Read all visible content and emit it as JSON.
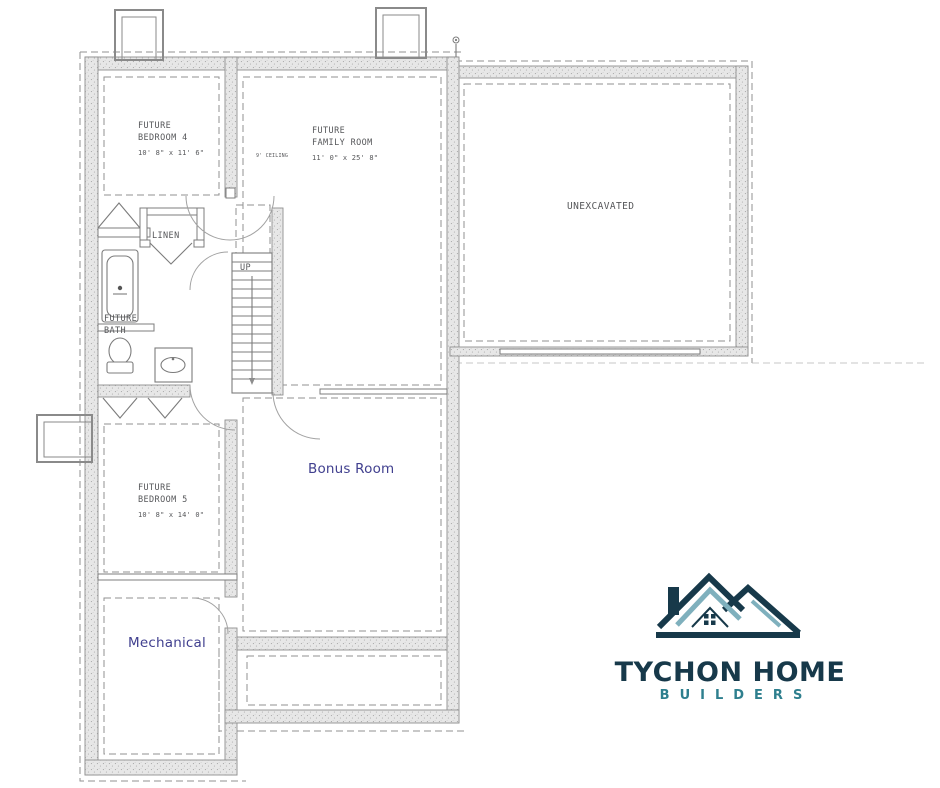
{
  "plan": {
    "title": "Basement / foundation floor plan",
    "rooms": {
      "bedroom4": {
        "line1": "FUTURE",
        "line2": "BEDROOM 4",
        "dims": "10' 8\" x 11' 6\""
      },
      "family_room": {
        "line1": "FUTURE",
        "line2": "FAMILY ROOM",
        "dims": "11' 0\" x 25' 8\""
      },
      "unexcavated": {
        "label": "UNEXCAVATED"
      },
      "linen": {
        "label": "LINEN"
      },
      "bath": {
        "line1": "FUTURE",
        "line2": "BATH"
      },
      "bedroom5": {
        "line1": "FUTURE",
        "line2": "BEDROOM 5",
        "dims": "10' 8\" x 14' 0\""
      },
      "bonus_room": {
        "label": "Bonus Room"
      },
      "mechanical": {
        "label": "Mechanical"
      }
    },
    "annotations": {
      "stairs_direction": "UP",
      "ceiling_note": "9' CEILING"
    },
    "colors": {
      "wall_fill": "#e6e6e6",
      "wall_stroke": "#8f8f8f",
      "label_gray": "#56575a",
      "label_blue": "#41408f"
    }
  },
  "logo": {
    "title": "TYCHON HOME",
    "subtitle": "BUILDERS",
    "colors": {
      "dark_teal": "#17394a",
      "teal": "#2e7f8e",
      "light_teal": "#7fb0bd"
    }
  }
}
